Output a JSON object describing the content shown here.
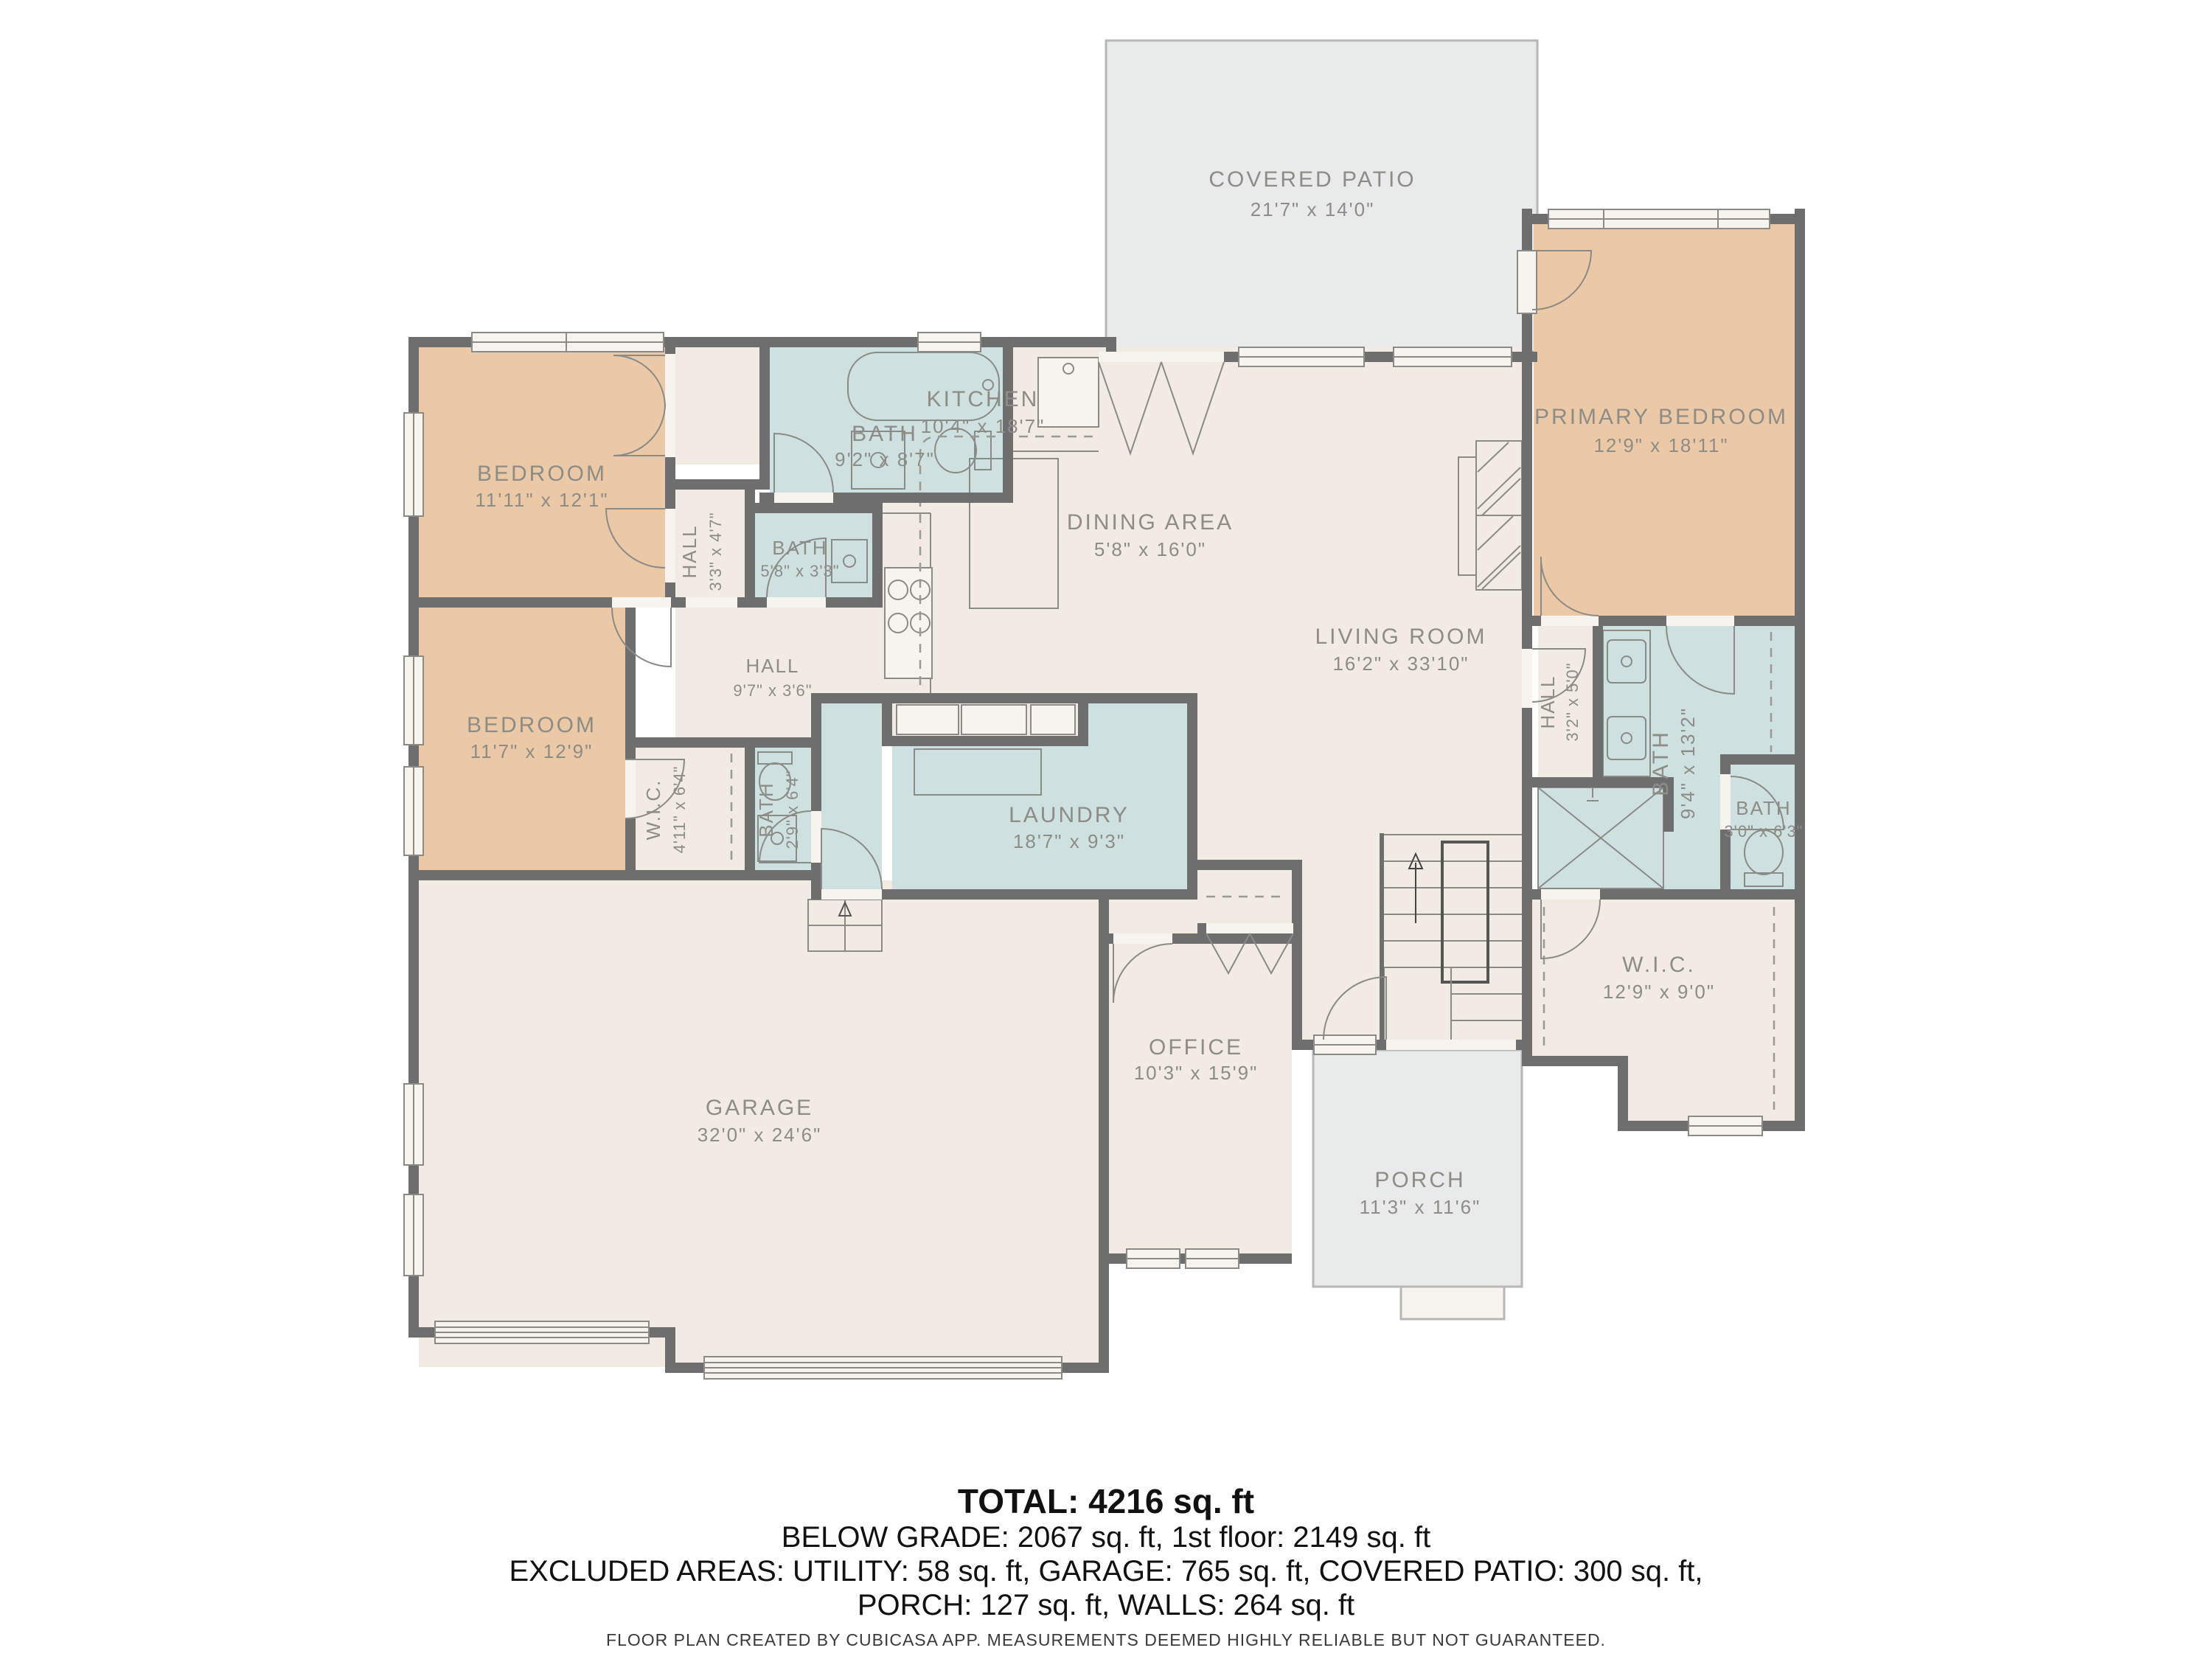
{
  "colors": {
    "wall": "#6e6e6e",
    "floor": "#f2ebe4",
    "bedroom": "#ecc9a6",
    "wet_room": "#cfe0e1",
    "outdoor": "#e9eaea",
    "label": "#8d8c86"
  },
  "rooms": {
    "covered_patio": {
      "name": "COVERED PATIO",
      "dims": "21'7\" x 14'0\""
    },
    "primary_bedroom": {
      "name": "PRIMARY BEDROOM",
      "dims": "12'9\" x 18'11\""
    },
    "kitchen": {
      "name": "KITCHEN",
      "dims": "10'4\" x 18'7\""
    },
    "dining_area": {
      "name": "DINING AREA",
      "dims": "5'8\" x 16'0\""
    },
    "living_room": {
      "name": "LIVING ROOM",
      "dims": "16'2\" x 33'10\""
    },
    "bedroom_top": {
      "name": "BEDROOM",
      "dims": "11'11\" x 12'1\""
    },
    "bedroom_bottom": {
      "name": "BEDROOM",
      "dims": "11'7\" x 12'9\""
    },
    "bath_main": {
      "name": "BATH",
      "dims": "9'2\" x 8'7\""
    },
    "bath_small": {
      "name": "BATH",
      "dims": "5'8\" x 3'3\""
    },
    "bath_lower": {
      "name": "BATH",
      "dims": "2'9\" x 6'4\""
    },
    "hall_small": {
      "name": "HALL",
      "dims": "3'3\" x 4'7\""
    },
    "hall_main": {
      "name": "HALL",
      "dims": "9'7\" x 3'6\""
    },
    "hall_suite": {
      "name": "HALL",
      "dims": "3'2\" x 5'0\""
    },
    "wic_small": {
      "name": "W.I.C.",
      "dims": "4'11\" x 6'4\""
    },
    "laundry": {
      "name": "LAUNDRY",
      "dims": "18'7\" x 9'3\""
    },
    "garage": {
      "name": "GARAGE",
      "dims": "32'0\" x 24'6\""
    },
    "office": {
      "name": "OFFICE",
      "dims": "10'3\" x 15'9\""
    },
    "porch": {
      "name": "PORCH",
      "dims": "11'3\" x 11'6\""
    },
    "primary_bath": {
      "name": "BATH",
      "dims": "9'4\" x 13'2\""
    },
    "toilet_room": {
      "name": "BATH",
      "dims": "3'0\" x 6'3\""
    },
    "primary_wic": {
      "name": "W.I.C.",
      "dims": "12'9\" x 9'0\""
    }
  },
  "summary": {
    "total": "TOTAL: 4216 sq. ft",
    "line2": "BELOW GRADE: 2067 sq. ft, 1st floor: 2149 sq. ft",
    "line3": "EXCLUDED AREAS: UTILITY: 58 sq. ft, GARAGE: 765 sq. ft, COVERED PATIO: 300 sq. ft,",
    "line4": "PORCH: 127 sq. ft, WALLS: 264 sq. ft"
  },
  "footer": {
    "text": "FLOOR PLAN CREATED BY CUBICASA APP. MEASUREMENTS DEEMED HIGHLY RELIABLE BUT NOT GUARANTEED."
  }
}
